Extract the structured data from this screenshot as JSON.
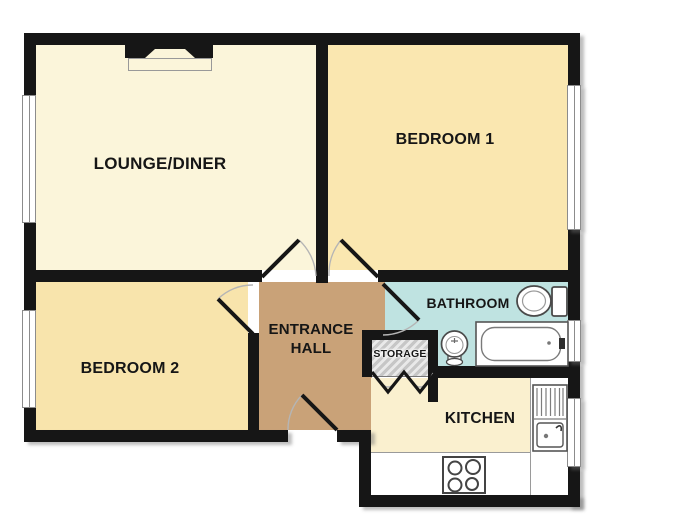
{
  "plan": {
    "title": "Two bedroom flat floor plan",
    "wall_color": "#161616",
    "background": "#ffffff",
    "rooms": {
      "lounge": {
        "label": "LOUNGE/DINER",
        "floor_color": "#fbf5da"
      },
      "bedroom1": {
        "label": "BEDROOM 1",
        "floor_color": "#fae7b0"
      },
      "bedroom2": {
        "label": "BEDROOM 2",
        "floor_color": "#f8e4ac"
      },
      "hall": {
        "label_line1": "ENTRANCE",
        "label_line2": "HALL",
        "floor_color": "#c9a278"
      },
      "bathroom": {
        "label": "BATHROOM",
        "floor_color": "#bfe3e1"
      },
      "storage": {
        "label": "STORAGE",
        "floor_color": "#cccccc"
      },
      "kitchen": {
        "label": "KITCHEN",
        "floor_color": "#faf0cf"
      }
    },
    "fixtures": [
      "fireplace",
      "toilet",
      "basin",
      "bathtub",
      "kitchen-sink-drainer",
      "hob"
    ],
    "windows": [
      "lounge-window-left",
      "bedroom2-window-left",
      "bedroom1-window-right",
      "bathroom-window-right",
      "kitchen-window-right"
    ],
    "doors": [
      "lounge-door",
      "bedroom1-door",
      "bedroom2-door",
      "bathroom-door",
      "storage-bifold-doors",
      "front-door"
    ]
  }
}
